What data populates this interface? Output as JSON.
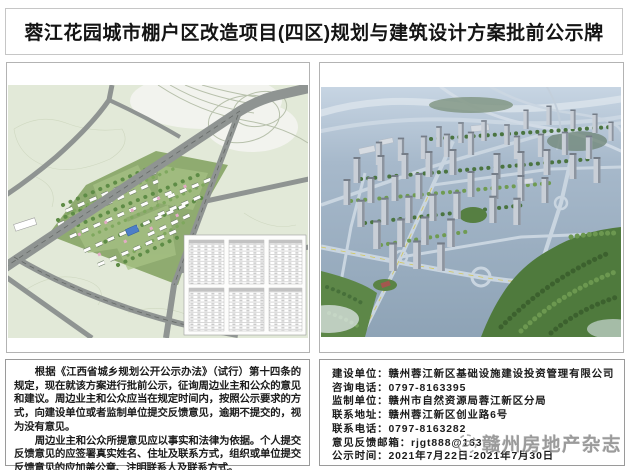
{
  "page": {
    "title": "蓉江花园城市棚户区改造项目(四区)规划与建筑设计方案批前公示牌"
  },
  "notice": {
    "paragraphs": [
      "根据《江西省城乡规划公开公示办法》（试行）第十四条的规定，现在就该方案进行批前公示，征询周边业主和公众的意见和建议。周边业主和公众应当在规定时间内，按照公示要求的方式，向建设单位或者监制单位提交反馈意见，逾期不提交的，视为没有意见。",
      "周边业主和公众所提意见应以事实和法律为依据。个人提交反馈意见的应签署真实姓名、住址及联系方式，组织或单位提交反馈意见的应加盖公章、注明联系人及联系方式。"
    ]
  },
  "contact": {
    "lines": [
      "建设单位：赣州蓉江新区基础设施建设投资管理有限公司",
      "咨询电话：0797-8163395",
      "监制单位：赣州市自然资源局蓉江新区分局",
      "联系地址：赣州蓉江新区创业路6号",
      "联系电话：0797-8163282",
      "意见反馈邮箱：rjgt888@163",
      "公示时间：2021年7月22日-2021年7月30日"
    ]
  },
  "watermark": {
    "text": "赣州房地产杂志"
  },
  "colors": {
    "map_background": "#e2e9d8",
    "map_road": "#8f9492",
    "site_green": "#8fab70",
    "render_sky": "#c7d5e3",
    "render_ground": "#8ea3b6",
    "forest_green": "#4f7a3d",
    "border_gray": "#9a9a9a"
  }
}
